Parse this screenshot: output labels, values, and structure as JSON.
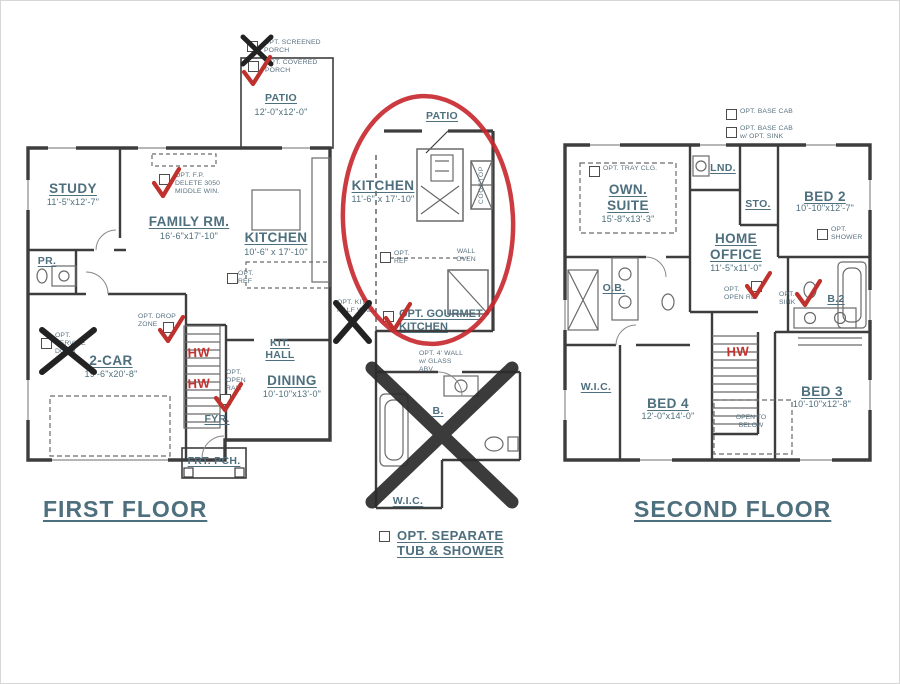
{
  "titles": {
    "first": "FIRST FLOOR",
    "second": "SECOND FLOOR"
  },
  "colors": {
    "ink": "#4e6f7d",
    "wall": "#3d3d3d",
    "marker_red": "#bf312d",
    "marker_black": "#2a2a2a"
  },
  "first_floor": {
    "patio": {
      "name": "PATIO",
      "dims": "12'-0\"x12'-0\""
    },
    "study": {
      "name": "STUDY",
      "dims": "11'-5\"x12'-7\""
    },
    "family": {
      "name": "FAMILY RM.",
      "dims": "16'-6\"x17'-10\""
    },
    "kitchen": {
      "name": "KITCHEN",
      "dims": "10'-6\" x 17'-10\""
    },
    "pr": {
      "name": "PR."
    },
    "garage": {
      "name": "2-CAR",
      "dims": "19'-6\"x20'-8\""
    },
    "kit_hall": {
      "name": "KIT.\nHALL"
    },
    "dining": {
      "name": "DINING",
      "dims": "10'-10\"x13'-0\""
    },
    "fyr": {
      "name": "FYR."
    },
    "frt_pch": {
      "name": "FRT. PCH."
    },
    "hw_upper": "HW",
    "hw_lower": "HW",
    "options": {
      "screened_porch": "OPT. SCREENED\nPORCH",
      "covered_porch": "OPT. COVERED\nPORCH",
      "fireplace": "OPT. F.P.\nDELETE 3050\nMIDDLE WIN.",
      "fridge": "OPT.\nREF",
      "half_wall": "OPT. KIT.\nHALF WALL",
      "service_door": "OPT.\nSERVICE\nDOOR",
      "drop_zone": "OPT. DROP\nZONE",
      "open_rail": "OPT.\nOPEN\nRAIL"
    }
  },
  "gourmet_inset": {
    "patio": "PATIO",
    "kitchen": {
      "name": "KITCHEN",
      "dims": "11'-6\" x 17'-10\""
    },
    "cooktop": "COOKTOP",
    "wall_oven": "WALL\nOVEN",
    "fridge": "OPT.\nREF",
    "option": "OPT. GOURMET\nKITCHEN"
  },
  "bath_inset": {
    "wall_note": "OPT. 4' WALL\nw/ GLASS\nABV.",
    "bath": "B.",
    "wic": "W.I.C.",
    "option": "OPT. SEPARATE\nTUB & SHOWER"
  },
  "second_floor": {
    "own_suite": {
      "name": "OWN.\nSUITE",
      "dims": "15'-8\"x13'-3\""
    },
    "lnd": {
      "name": "LND."
    },
    "sto": {
      "name": "STO."
    },
    "bed2": {
      "name": "BED 2",
      "dims": "10'-10\"x12'-7\""
    },
    "home_office": {
      "name": "HOME\nOFFICE",
      "dims": "11'-5\"x11'-0\""
    },
    "ob": {
      "name": "O.B."
    },
    "b2": {
      "name": "B.2"
    },
    "wic": {
      "name": "W.I.C."
    },
    "bed4": {
      "name": "BED 4",
      "dims": "12'-0\"x14'-0\""
    },
    "bed3": {
      "name": "BED 3",
      "dims": "10'-10\"x12'-8\""
    },
    "open_below": "OPEN TO\nBELOW",
    "hw": "HW",
    "options": {
      "base_cab": "OPT. BASE CAB",
      "base_cab_sink": "OPT. BASE CAB\nw/ OPT. SINK",
      "tray_clg": "OPT. TRAY CLG.",
      "shower": "OPT.\nSHOWER",
      "open_rail": "OPT.\nOPEN RL.",
      "sink": "OPT.\nSINK"
    }
  }
}
